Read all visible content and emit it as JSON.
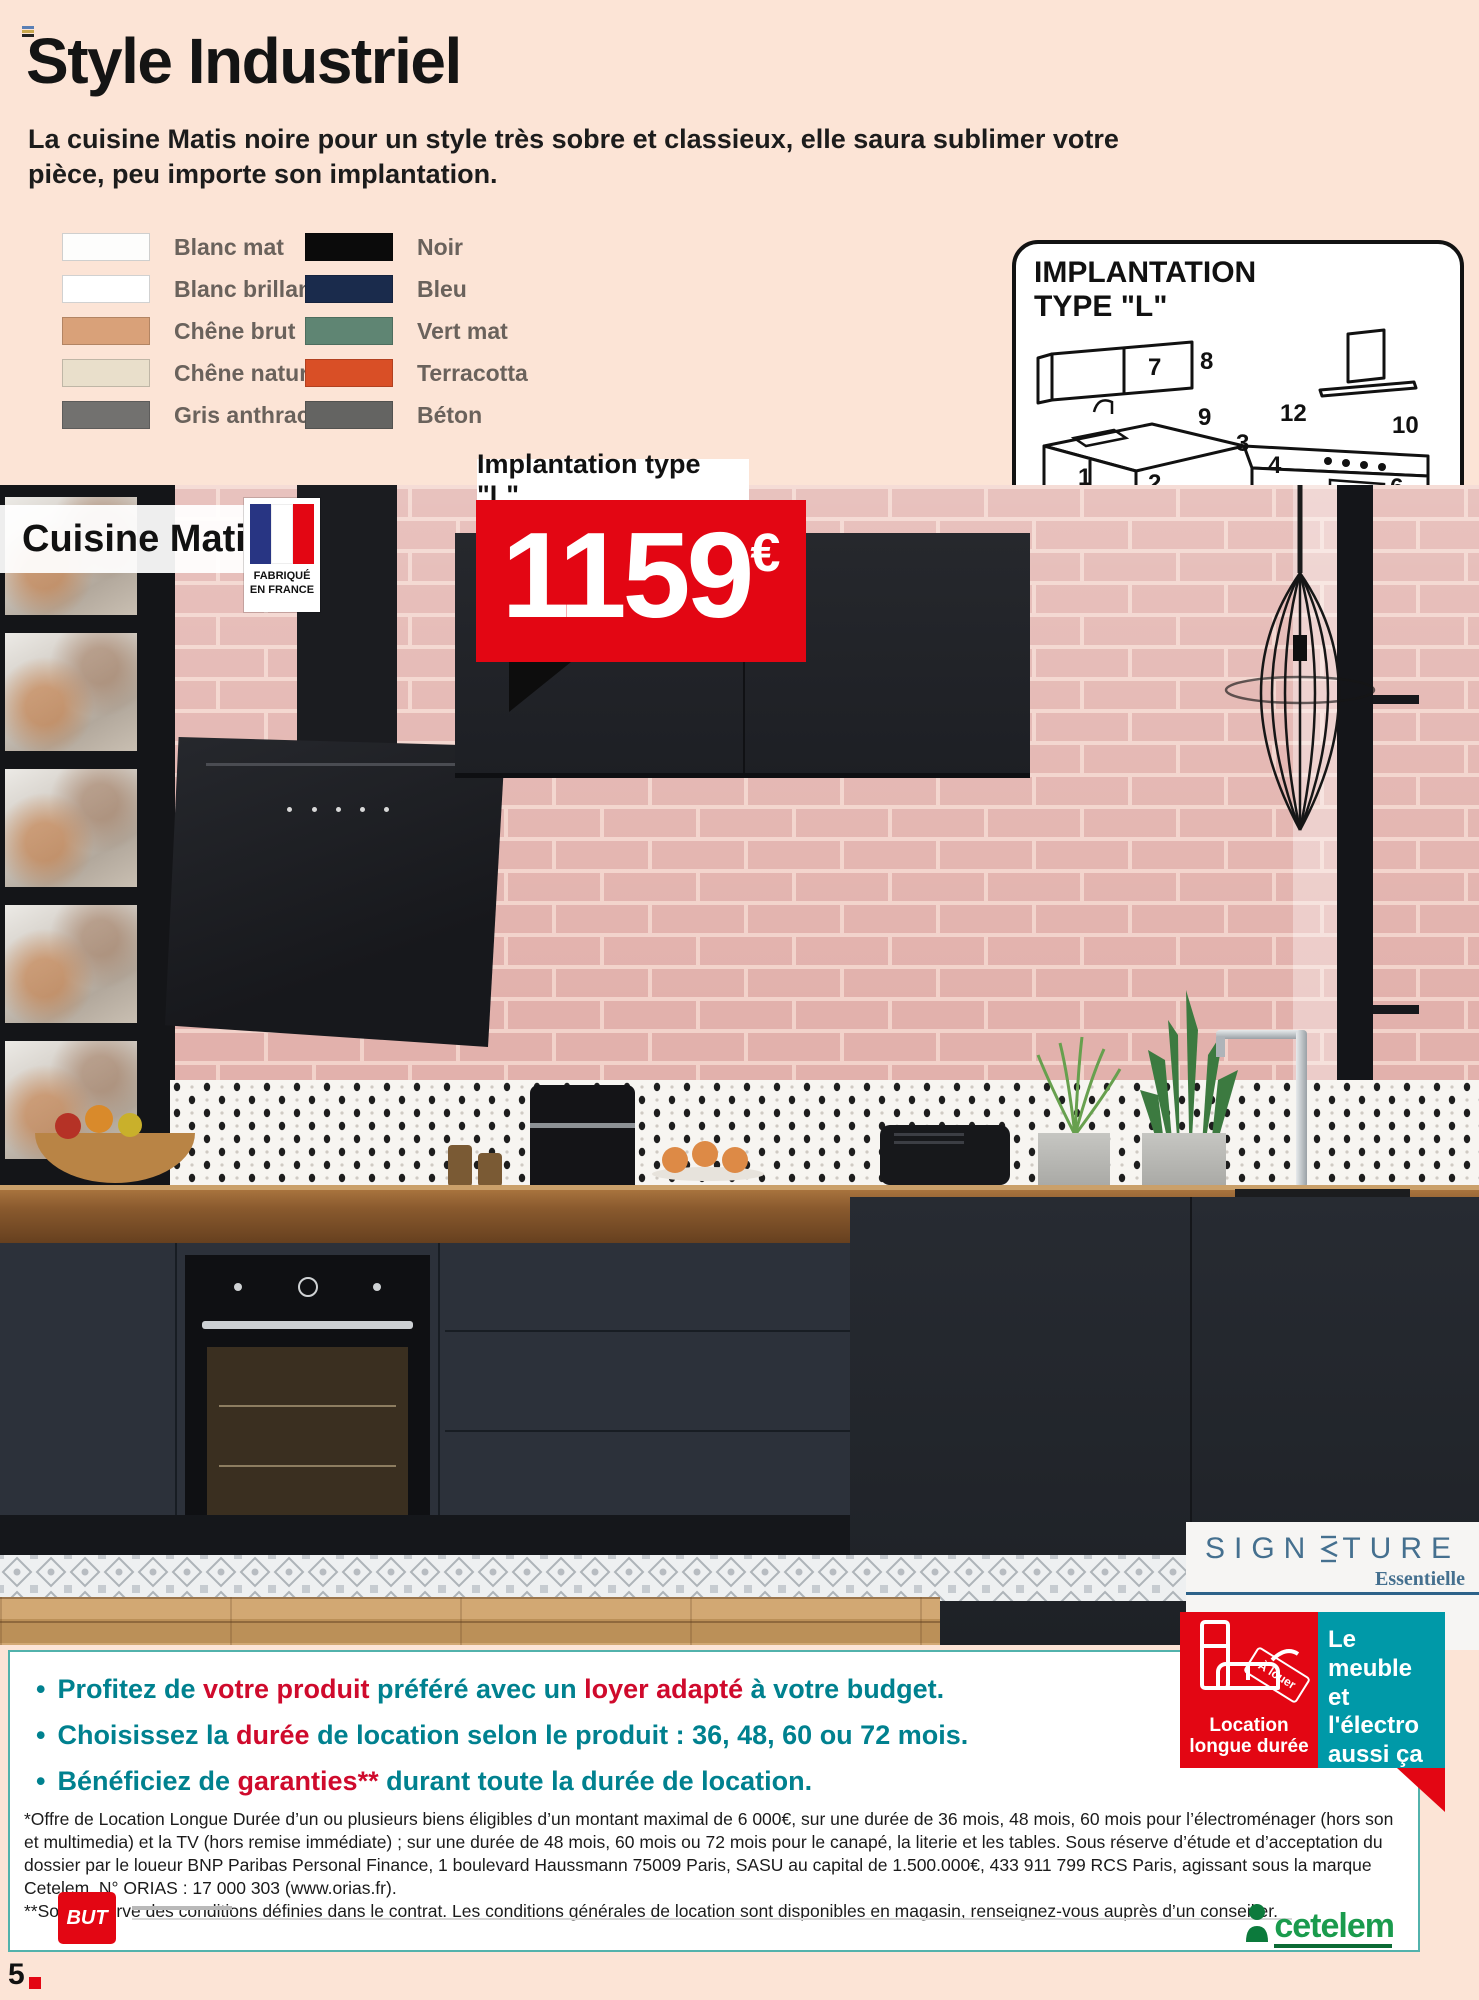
{
  "header": {
    "title": "Style Industriel",
    "subtitle": "La cuisine Matis noire pour un style très sobre et classieux, elle saura sublimer votre pièce, peu importe son implantation."
  },
  "swatches": {
    "left": [
      {
        "label": "Blanc mat",
        "hex": "#fdfdfc"
      },
      {
        "label": "Blanc brillant",
        "hex": "#ffffff"
      },
      {
        "label": "Chêne brut",
        "hex": "#d9a179"
      },
      {
        "label": "Chêne naturel",
        "hex": "#e9dfcb"
      },
      {
        "label": "Gris anthracite",
        "hex": "#72716f"
      }
    ],
    "right": [
      {
        "label": "Noir",
        "hex": "#0b0b0b"
      },
      {
        "label": "Bleu",
        "hex": "#1a2b4c"
      },
      {
        "label": "Vert mat",
        "hex": "#5f8573"
      },
      {
        "label": "Terracotta",
        "hex": "#d94f26"
      },
      {
        "label": "Béton",
        "hex": "#646462"
      }
    ]
  },
  "implantation": {
    "title_line1": "IMPLANTATION",
    "title_line2": "TYPE \"L\"",
    "caption": "(sans électroménager, évier, robinetterie)",
    "unit_numbers": [
      "7",
      "8",
      "9",
      "12",
      "10",
      "3",
      "1",
      "2",
      "4",
      "11",
      "5",
      "6"
    ]
  },
  "product": {
    "name": "Cuisine Matis",
    "made_in_line1": "FABRIQUÉ",
    "made_in_line2": "EN FRANCE"
  },
  "price": {
    "implantation_label": "Implantation type \"L\"",
    "value": "1159",
    "currency": "€"
  },
  "signature": {
    "brand_left": "SIGN",
    "brand_right": "TURE",
    "subtitle": "Essentielle"
  },
  "rental_badge": {
    "tag": "À louer",
    "label": "Location longue durée",
    "message": "Le meuble et l'électro aussi ça se loue*",
    "red": "#e30613",
    "teal": "#0099a8"
  },
  "legal_box": {
    "bullets": [
      {
        "parts": [
          {
            "text": "Profitez de ",
            "style": "teal"
          },
          {
            "text": "votre produit",
            "style": "red"
          },
          {
            "text": " préféré avec un ",
            "style": "teal"
          },
          {
            "text": "loyer adapté",
            "style": "red"
          },
          {
            "text": " à votre budget.",
            "style": "teal"
          }
        ]
      },
      {
        "parts": [
          {
            "text": "Choisissez la ",
            "style": "teal"
          },
          {
            "text": "durée",
            "style": "red"
          },
          {
            "text": " de location selon le produit : 36, 48, 60 ou 72 mois.",
            "style": "teal"
          }
        ]
      },
      {
        "parts": [
          {
            "text": "Bénéficiez de ",
            "style": "teal"
          },
          {
            "text": "garanties**",
            "style": "red"
          },
          {
            "text": " durant toute la durée de location.",
            "style": "teal"
          }
        ]
      }
    ],
    "paragraph1": "*Offre de Location Longue Durée d’un ou plusieurs biens éligibles d’un montant maximal de 6 000€, sur une durée de 36 mois, 48 mois, 60 mois pour l’électroménager (hors son et multimedia) et la TV (hors remise immédiate) ; sur une durée de 48 mois, 60 mois ou 72 mois pour le canapé, la literie et les tables. Sous réserve d’étude et d’acceptation du dossier par le loueur BNP Paribas Personal Finance, 1 boulevard Haussmann 75009 Paris, SASU au capital de 1.500.000€, 433 911 799 RCS Paris, agissant sous la marque Cetelem. N° ORIAS : 17 000 303 (www.orias.fr).",
    "paragraph2": "**Sous réserve des conditions définies dans le contrat. Les conditions générales de location sont disponibles en magasin, renseignez-vous auprès d’un conseiller."
  },
  "footer": {
    "but_label": "BUT",
    "cetelem_label": "cetelem",
    "page_number": "5"
  }
}
